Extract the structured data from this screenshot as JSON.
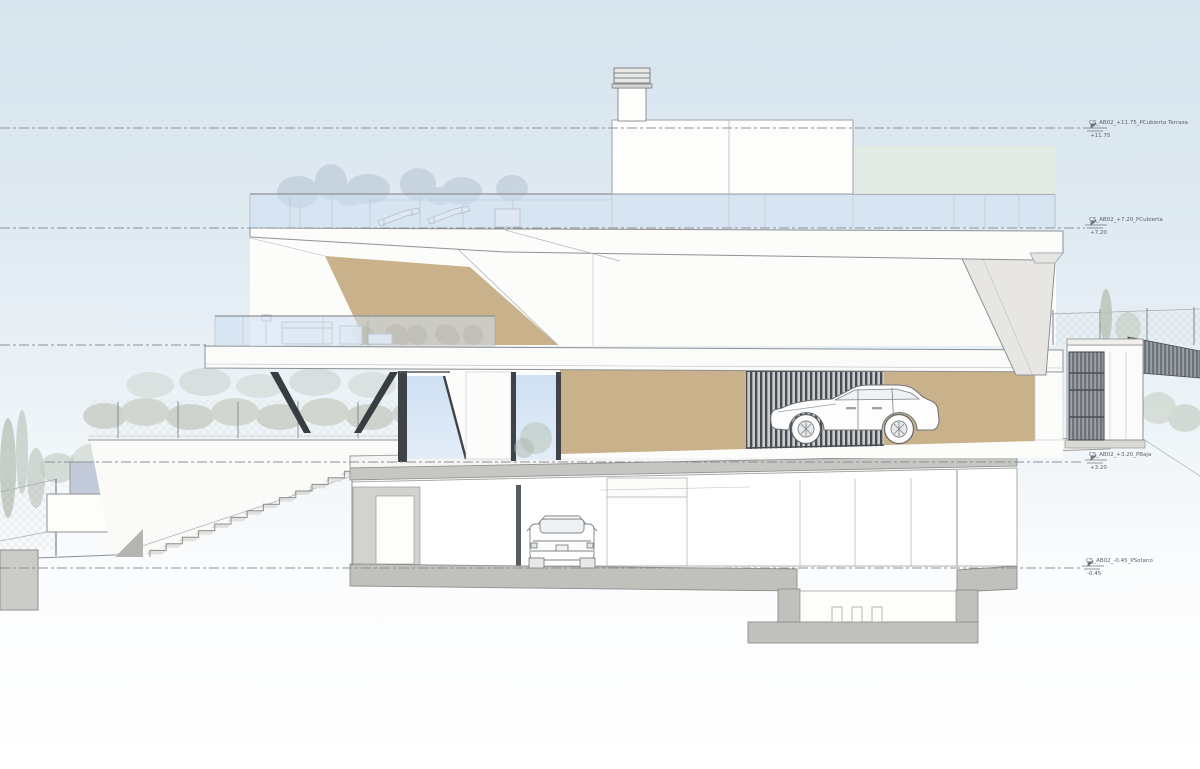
{
  "drawing": {
    "type": "architectural-section-elevation",
    "levels": [
      {
        "id": "p-cubierta-terraza",
        "label": "CS_AB02_+11.75_PCubierta Terraza",
        "value": "+11.75"
      },
      {
        "id": "p-cubierta",
        "label": "CS_AB02_+7.20_PCubierta",
        "value": "+7.20"
      },
      {
        "id": "p-baja",
        "label": "CS_AB02_+3.20_PBaja",
        "value": "+3.20"
      },
      {
        "id": "p-sotano",
        "label": "CS_AB02_-0.45_PSotano",
        "value": "-0.45"
      }
    ],
    "colors": {
      "sky_top": "#d7e5ee",
      "glass": "#cfe0f2",
      "tan_wall": "#c9b28b",
      "bush": "#b29a73",
      "slab_gray": "#c0c0bd",
      "dark_slat": "#474c50",
      "drawing_line": "#8e9194",
      "vegetation": "#c9cfc6"
    }
  }
}
